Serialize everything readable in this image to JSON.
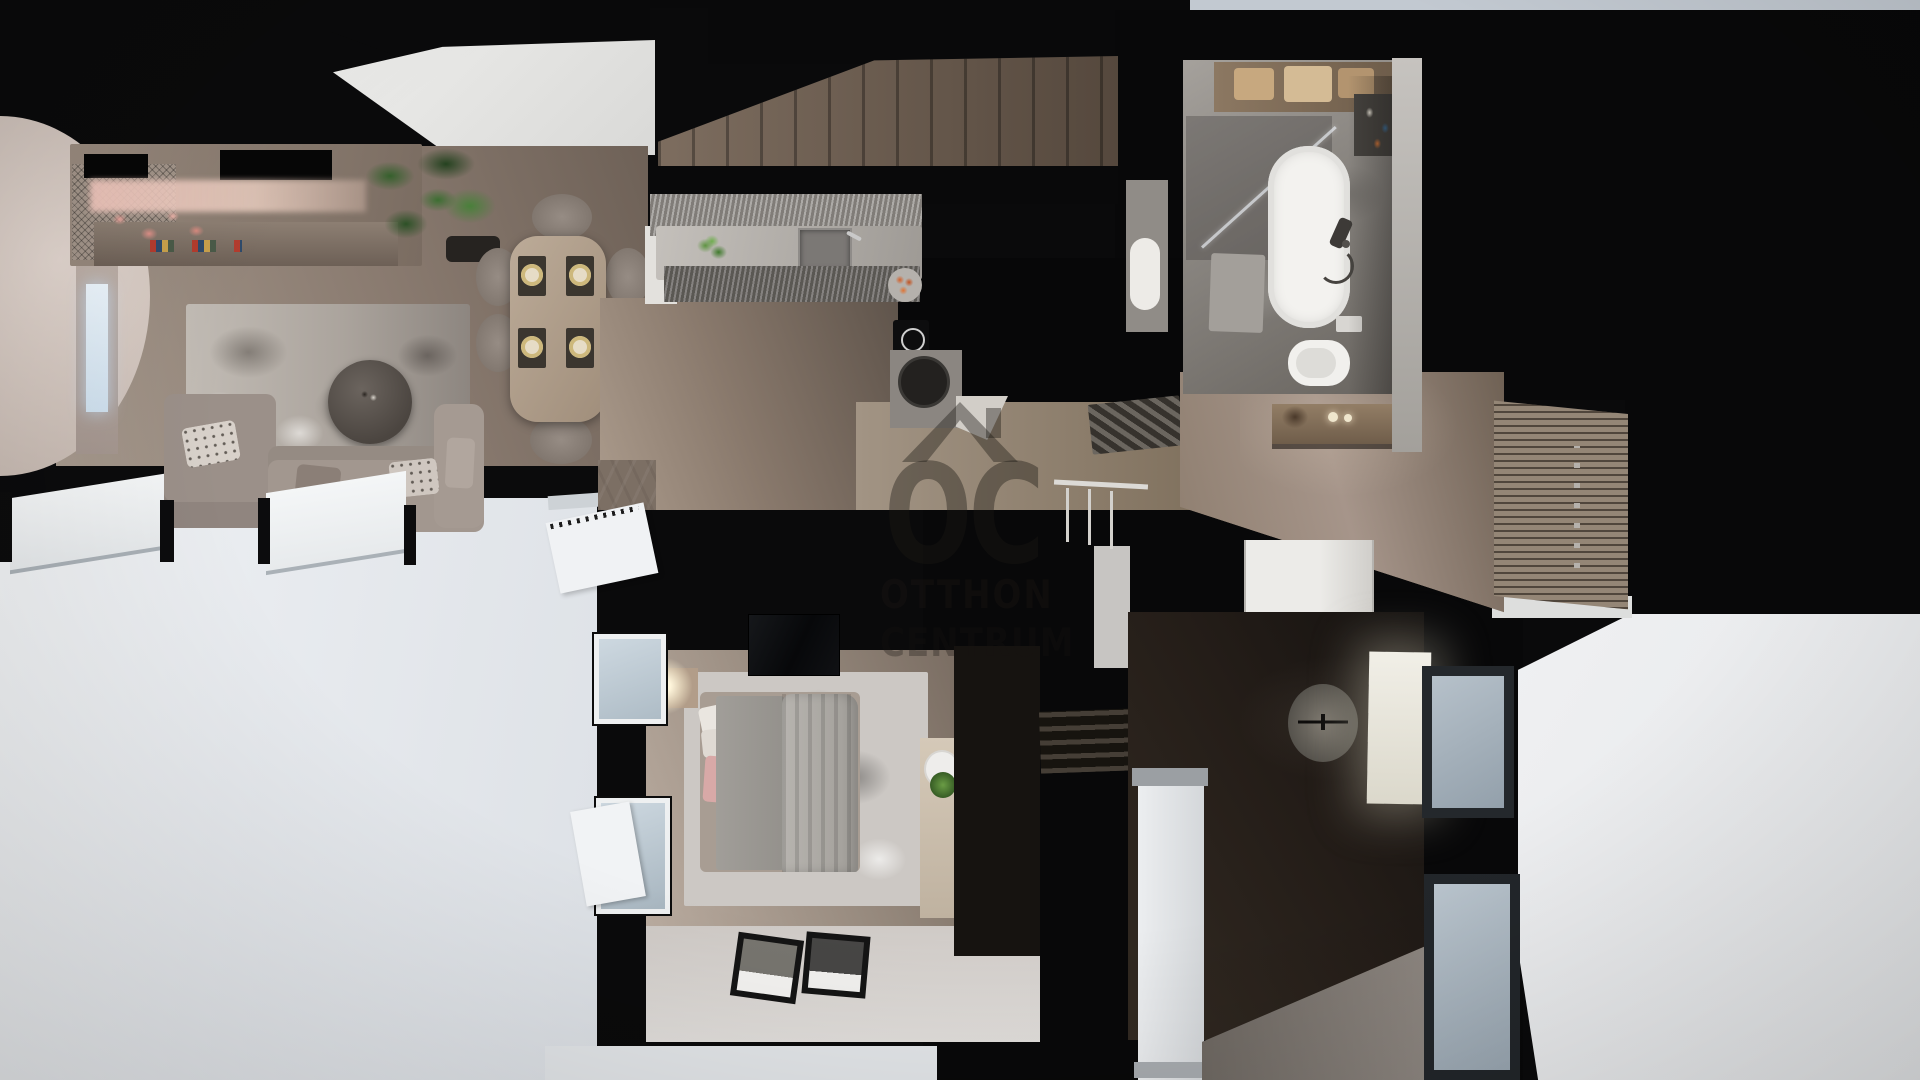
{
  "scene": {
    "type": "3d-floor-plan-top-view-render",
    "setting": "apartment dollhouse view",
    "watermark": {
      "monogram": "OC",
      "line1": "OTTHON",
      "line2": "CENTRUM"
    },
    "palette": {
      "background_walls": "#0a0a0b",
      "wood_floor": "#8a7b70",
      "dark_wood_floor": "#2e2620",
      "exterior_white": "#e9ecef",
      "sky_sliver": "#b7c0ca",
      "living_rug": "#b3aca6",
      "bedroom_rug": "#ccc8c4",
      "sofa_fabric": "#a2978f",
      "bathtub_white": "#f3f2ef",
      "warm_shelf_glow": "#e9c9bd",
      "plant_green": "#3f6b38",
      "watermark_ink": "rgba(28,24,20,0.4)"
    },
    "rooms": [
      {
        "name": "living-room",
        "items": [
          "media-wall-tv",
          "shelf-lighting-glow",
          "flower-decor",
          "fireplace-panel",
          "curved-wall",
          "area-rug",
          "round-coffee-table",
          "corner-sofa",
          "armchair",
          "throw-pillows",
          "dining-table",
          "dining-chairs-x6",
          "place-settings-x4",
          "potted-plant"
        ]
      },
      {
        "name": "kitchen",
        "items": [
          "staircase-up",
          "fluted-cabinets",
          "stone-countertop",
          "sink",
          "faucet",
          "herb-plant",
          "fruit-bowl",
          "induction-cooktop",
          "black-island",
          "round-basin",
          "striped-doormat"
        ]
      },
      {
        "name": "hallway",
        "items": [
          "console-table",
          "table-lamps",
          "slatted-wardrobe-with-knobs"
        ]
      },
      {
        "name": "bathroom",
        "items": [
          "towel-shelf",
          "cosmetic-shelf",
          "walk-in-shower",
          "glass-screen",
          "bathtub",
          "hand-shower",
          "bath-mat",
          "wall-hung-toilet",
          "flush-plate",
          "washbasin"
        ]
      },
      {
        "name": "bedroom",
        "items": [
          "double-bed",
          "draped-duvet",
          "pillows",
          "pink-accent-pillow",
          "glowing-bedside-lamp",
          "nightstand",
          "area-rug",
          "vanity-desk",
          "white-chair",
          "small-plant",
          "dark-wardrobe",
          "wall-tv",
          "leaning-picture-frames-x2",
          "tilt-open-windows"
        ]
      },
      {
        "name": "study",
        "items": [
          "office-chair",
          "illuminated-desk",
          "dark-herringbone-floor",
          "windows-x2",
          "staircase-down",
          "stair-railing",
          "structural-column",
          "entry-closet"
        ]
      },
      {
        "name": "exterior",
        "items": [
          "white-terrace-surfaces",
          "open-window-leaves",
          "sky-sliver"
        ]
      }
    ]
  }
}
